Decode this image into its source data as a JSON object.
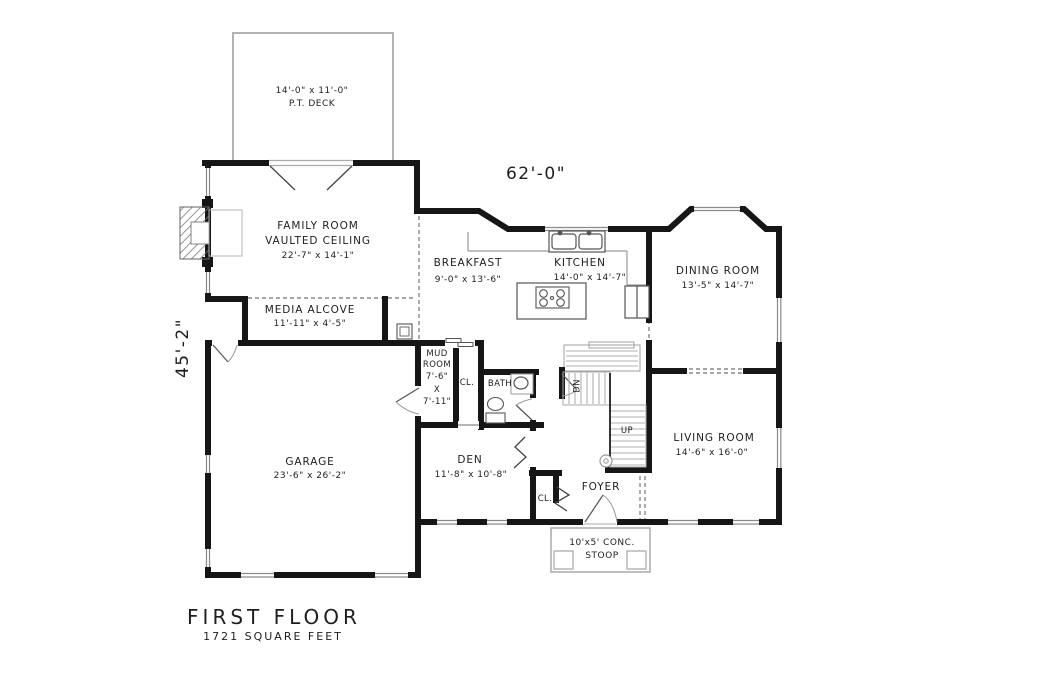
{
  "drawing": {
    "title": "FIRST FLOOR",
    "subtitle": "1721 SQUARE FEET",
    "width_dim": "62'-0\"",
    "depth_dim": "45'-2\""
  },
  "outdoor": {
    "deck_dims": "14'-0\" x 11'-0\"",
    "deck_name": "P.T. DECK",
    "stoop_line1": "10'x5' CONC.",
    "stoop_line2": "STOOP"
  },
  "rooms": {
    "family_room": {
      "name": "FAMILY ROOM",
      "note": "VAULTED CEILING",
      "dims": "22'-7\" x 14'-1\""
    },
    "media_alcove": {
      "name": "MEDIA ALCOVE",
      "dims": "11'-11\" x 4'-5\""
    },
    "breakfast": {
      "name": "BREAKFAST",
      "dims": "9'-0\" x 13'-6\""
    },
    "kitchen": {
      "name": "KITCHEN",
      "dims": "14'-0\" x 14'-7\""
    },
    "dining_room": {
      "name": "DINING ROOM",
      "dims": "13'-5\" x 14'-7\""
    },
    "living_room": {
      "name": "LIVING ROOM",
      "dims": "14'-6\" x 16'-0\""
    },
    "den": {
      "name": "DEN",
      "dims": "11'-8\" x 10'-8\""
    },
    "garage": {
      "name": "GARAGE",
      "dims": "23'-6\" x 26'-2\""
    },
    "mud_room": {
      "lines": [
        "MUD",
        "ROOM",
        "7'-6\"",
        "X",
        "7'-11\""
      ]
    },
    "foyer": {
      "name": "FOYER"
    },
    "bath": {
      "name": "BATH"
    }
  },
  "labels": {
    "mud_closet": "CL.",
    "foyer_closet": "CL.",
    "stairs_down": "DN",
    "stairs_up": "UP"
  },
  "colors": {
    "wall": "#161616",
    "thin_line": "#9a9a9a",
    "outline_gray": "#b3b3b3",
    "text": "#1e1e1e"
  }
}
